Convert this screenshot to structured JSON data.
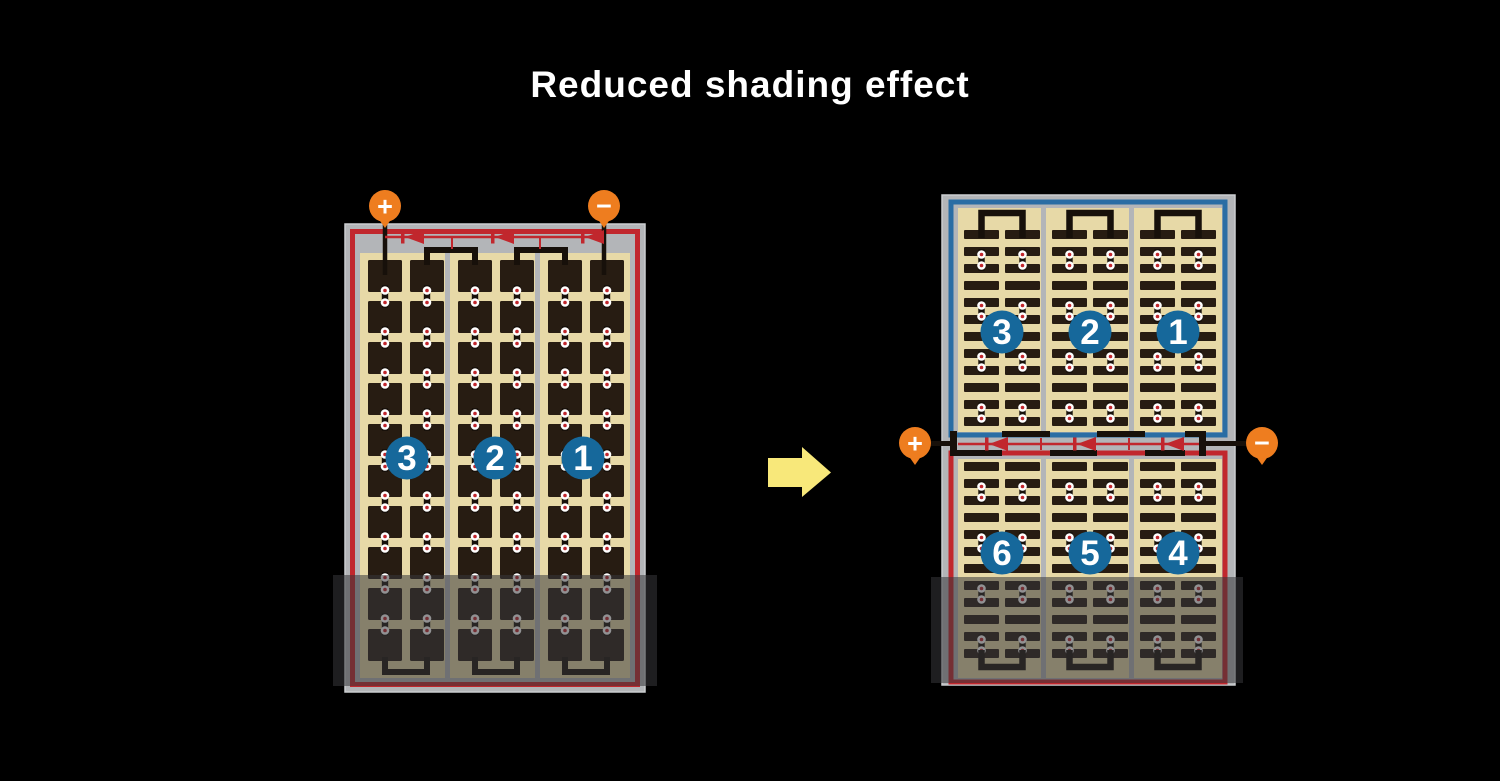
{
  "title": "Reduced shading effect",
  "colors": {
    "background": "#000000",
    "title_text": "#ffffff",
    "panel_frame": "#b3b5b8",
    "frame_edge": "#cbcdcf",
    "cell_field": "#e7d9a7",
    "cell_dark": "#271c12",
    "wire_black": "#17100a",
    "circuit_red": "#c1272d",
    "circuit_blue": "#2a6da4",
    "badge_blue": "#16689b",
    "terminal_orange": "#ee7d1f",
    "arrow_yellow": "#f8e87a",
    "shade_overlay": "rgba(55,55,58,0.55)"
  },
  "left_panel": {
    "terminals": {
      "plus": "+",
      "minus": "−"
    },
    "groups": [
      {
        "label": "3"
      },
      {
        "label": "2"
      },
      {
        "label": "1"
      }
    ]
  },
  "right_panel": {
    "terminals": {
      "plus": "+",
      "minus": "−"
    },
    "top_groups": [
      {
        "label": "3"
      },
      {
        "label": "2"
      },
      {
        "label": "1"
      }
    ],
    "bottom_groups": [
      {
        "label": "6"
      },
      {
        "label": "5"
      },
      {
        "label": "4"
      }
    ]
  }
}
